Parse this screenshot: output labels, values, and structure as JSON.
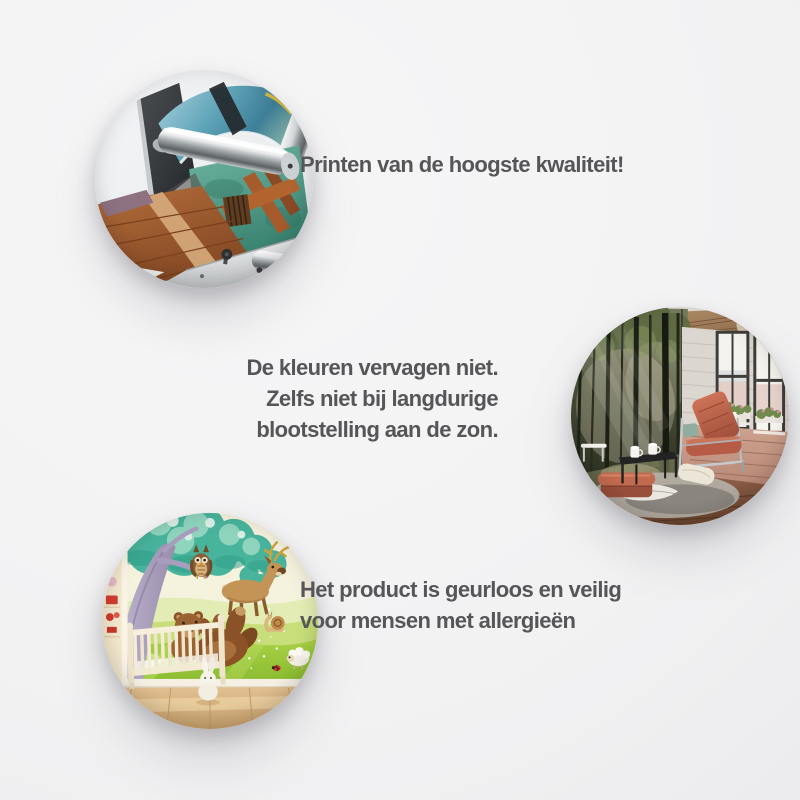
{
  "page": {
    "background": "#f1f1f2",
    "text_color": "#565659"
  },
  "features": [
    {
      "id": "print-quality",
      "photo": "large-format-printer-printing-wall-mural",
      "lines": [
        "Printen van de hoogste kwaliteit!"
      ]
    },
    {
      "id": "fade-resistant",
      "photo": "living-room-with-forest-wall-mural",
      "lines": [
        "De kleuren vervagen niet.",
        "Zelfs niet bij langdurige",
        "blootstelling aan de zon."
      ]
    },
    {
      "id": "odorless-allergy-safe",
      "photo": "nursery-with-animal-wall-mural",
      "lines": [
        "Het product is geurloos en veilig",
        "voor mensen met allergieën"
      ]
    }
  ]
}
